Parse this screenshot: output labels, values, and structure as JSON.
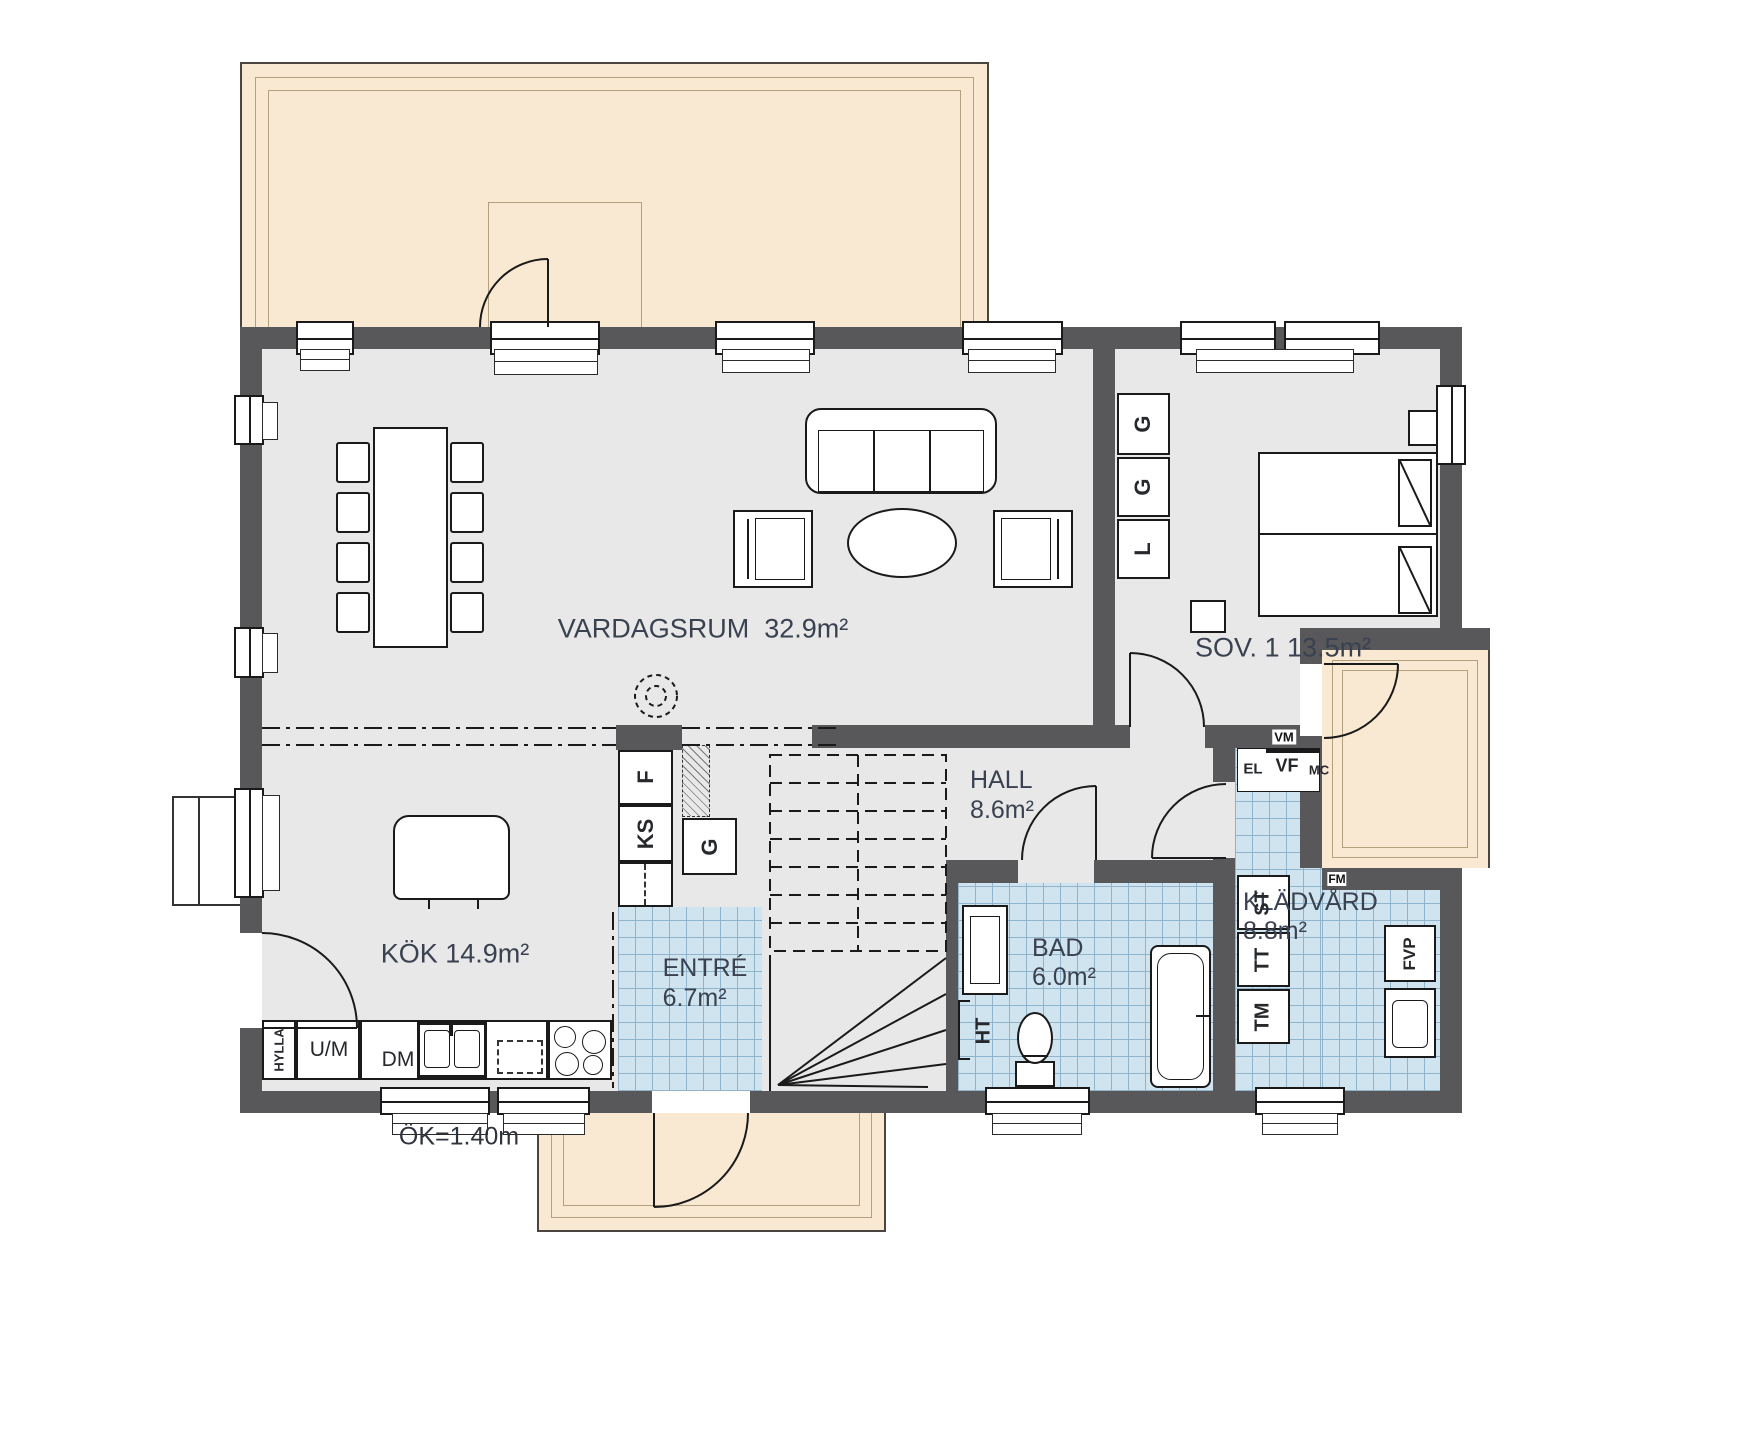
{
  "floorplan": {
    "rooms": [
      {
        "name": "VARDAGSRUM",
        "area": "32.9m²"
      },
      {
        "name": "SOV. 1",
        "area": "13.5m²"
      },
      {
        "name": "KÖK",
        "area": "14.9m²"
      },
      {
        "name": "HALL",
        "area": "8.6m²"
      },
      {
        "name": "ENTRÉ",
        "area": "6.7m²"
      },
      {
        "name": "BAD",
        "area": "6.0m²"
      },
      {
        "name": "KLÄDVÅRD",
        "area": "8.8m²"
      }
    ],
    "fixtures": {
      "freezer": "F",
      "fridge": "KS",
      "wardrobe": "G",
      "linen": "L",
      "shelf": "HYLLA",
      "oven_micro": "U/M",
      "dishwasher": "DM",
      "towel_dryer": "HT",
      "cleaning_cab": "ST",
      "dryer": "TT",
      "washer": "TM",
      "heat_pump": "FVP",
      "water_meter": "VM",
      "electrical": "EL",
      "water_manifold": "VF",
      "media_central": "MC",
      "vent": "FM"
    },
    "annotations": {
      "window_height": "ÖK=1.40m"
    },
    "colors": {
      "wall": "#58585b",
      "floor": "#e8e8e8",
      "tile": "#cfe4ef",
      "terrace": "#f9e9d3"
    }
  }
}
